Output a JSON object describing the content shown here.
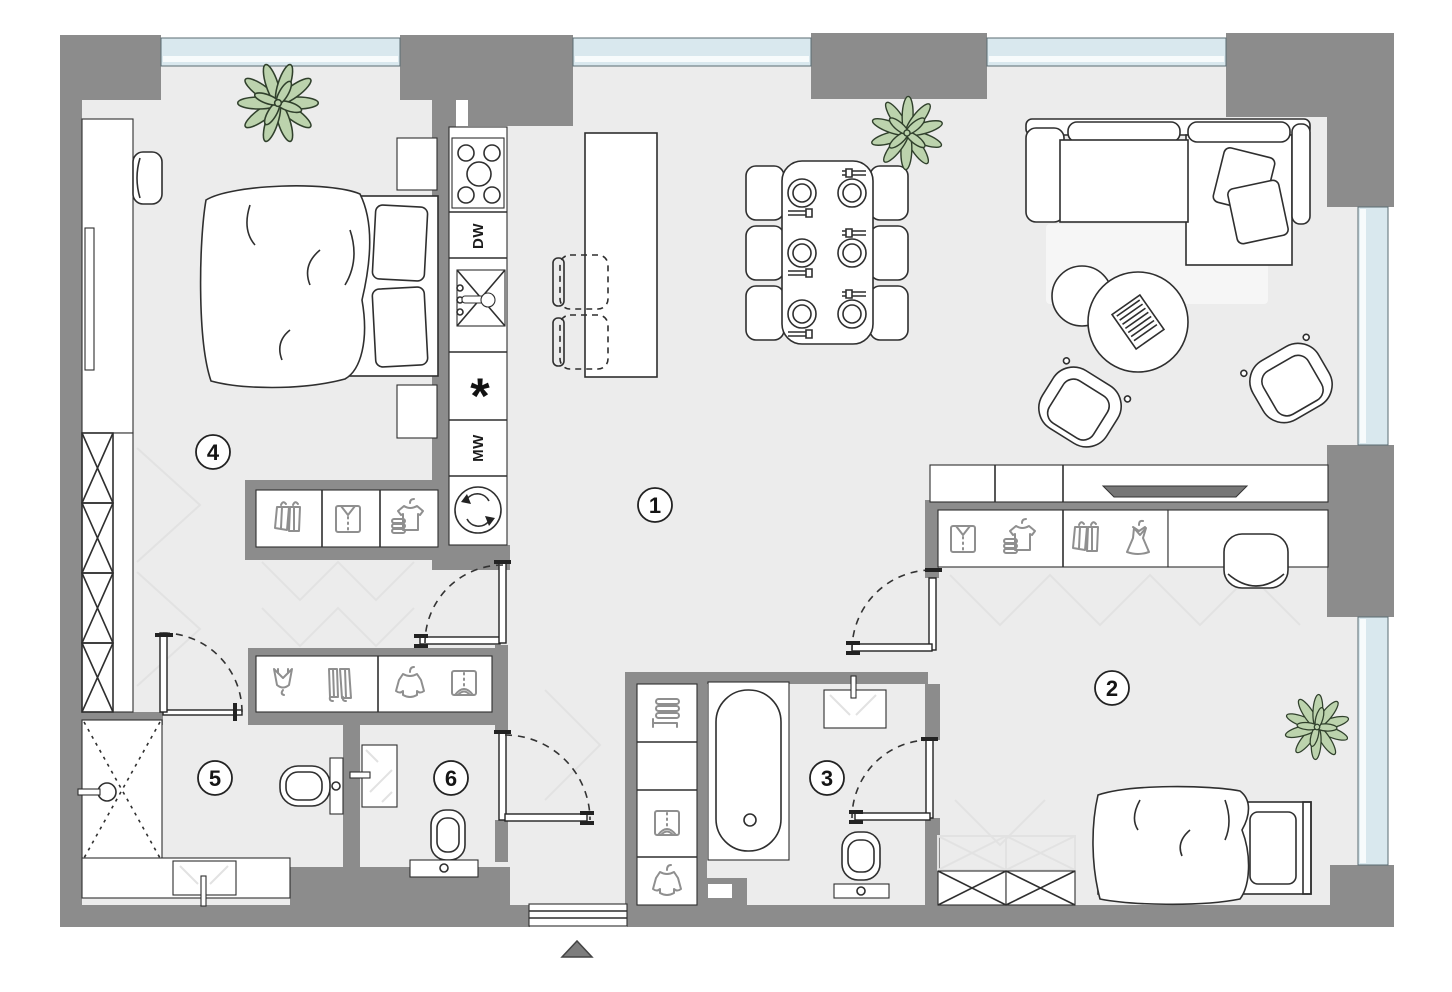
{
  "title": "Apartment floor plan",
  "colors": {
    "wall": "#8c8c8c",
    "floor": "#ececec",
    "window": "#d9e8ee",
    "window_inner": "#f7fbfc",
    "line": "#2f2f2f",
    "icon": "#8f8f8f",
    "plant_fill": "#bcd3ad",
    "plant_stroke": "#30402c",
    "ghost": "#e2e2e2",
    "tv": "#777777",
    "triangle": "#7d7d7d"
  },
  "rooms": [
    {
      "label": "1"
    },
    {
      "label": "2"
    },
    {
      "label": "3"
    },
    {
      "label": "4"
    },
    {
      "label": "5"
    },
    {
      "label": "6"
    }
  ],
  "kitchen": {
    "dishwasher_label": "DW",
    "microwave_label": "MW",
    "freezer_symbol": "*",
    "appliances": [
      "cooktop",
      "dishwasher",
      "sink",
      "freezer",
      "microwave",
      "washing-machine"
    ]
  },
  "furniture_icons": {
    "bedroom4_wardrobe": [
      "hanging-clothes",
      "folded-shirt",
      "t-shirt-stack"
    ],
    "hallway_closet": [
      "lingerie",
      "hanging-pants",
      "hanging-jacket",
      "folded-garment"
    ],
    "bathroom3_closet": [
      "towel-stack",
      "folded-garment",
      "hanging-jacket"
    ],
    "bedroom2_wardrobe": [
      "folded-shirt",
      "t-shirt-stack",
      "hanging-clothes",
      "dress"
    ]
  },
  "entrance": {
    "marker": "entrance-direction-triangle"
  }
}
